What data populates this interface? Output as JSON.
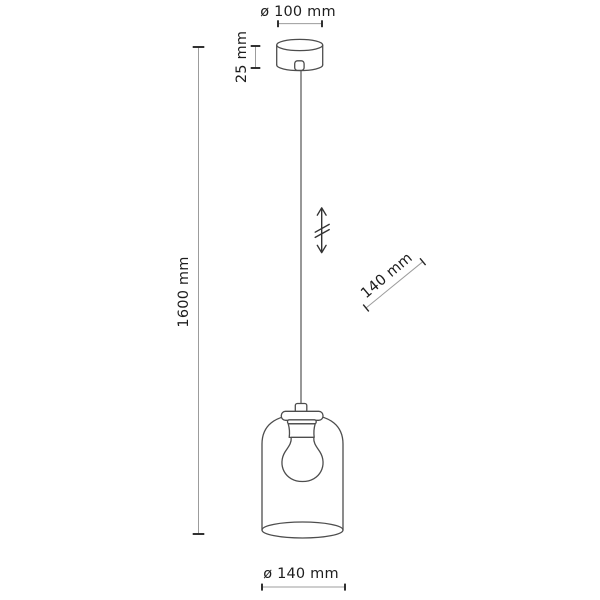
{
  "page": {
    "background": "#ffffff",
    "figure": "pendant-lamp-dimension-drawing"
  },
  "colors": {
    "drawing_outline": "#4d4d4d",
    "dimension_stem": "#9c9c9c",
    "dimension_tick": "#262626",
    "label_text": "#1d1d1d"
  },
  "dimensions": {
    "canopy_diameter": {
      "label": "ø 100 mm"
    },
    "canopy_height": {
      "label": "25 mm"
    },
    "total_height": {
      "label": "1600 mm"
    },
    "shade_size": {
      "label": "140 mm"
    },
    "shade_diameter": {
      "label": "ø 140 mm"
    }
  },
  "icons": [
    {
      "name": "adjustable-height-arrow",
      "meaning": "double-headed vertical arrow with break marks (adjustable cord length)"
    }
  ],
  "parts": [
    "ceiling-canopy",
    "cord-grip",
    "suspension-cord",
    "glass-shade",
    "socket-flange",
    "lamp-socket",
    "light-bulb"
  ]
}
